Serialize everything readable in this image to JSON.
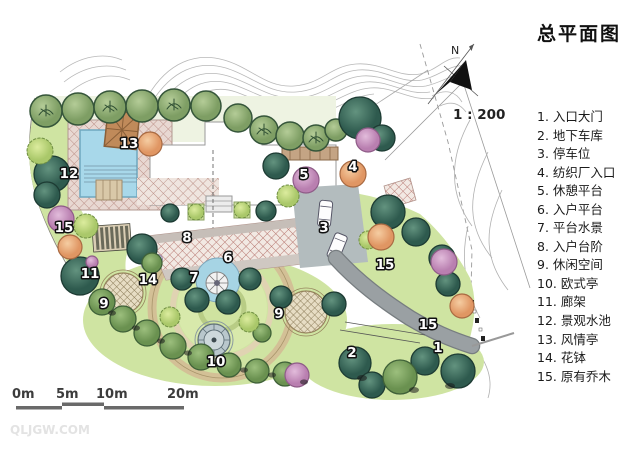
{
  "title": "总平面图",
  "north": {
    "label": "N",
    "scale_text": "1 : 200"
  },
  "legend": {
    "items": [
      "1. 入口大门",
      "2. 地下车库",
      "3. 停车位",
      "4. 纺织厂入口",
      "5. 休憩平台",
      "6. 入户平台",
      "7. 平台水景",
      "8. 入户台阶",
      "9. 休闲空间",
      "10. 欧式亭",
      "11. 廊架",
      "12. 景观水池",
      "13. 风情亭",
      "14. 花钵",
      "15. 原有乔木"
    ]
  },
  "markers": [
    {
      "num": "12"
    },
    {
      "num": "13"
    },
    {
      "num": "15"
    },
    {
      "num": "8"
    },
    {
      "num": "6"
    },
    {
      "num": "7"
    },
    {
      "num": "14"
    },
    {
      "num": "11"
    },
    {
      "num": "9"
    },
    {
      "num": "10"
    },
    {
      "num": "9"
    },
    {
      "num": "5"
    },
    {
      "num": "4"
    },
    {
      "num": "3"
    },
    {
      "num": "15"
    },
    {
      "num": "15"
    },
    {
      "num": "1"
    },
    {
      "num": "2"
    }
  ],
  "scalebar": {
    "labels": [
      "0m",
      "5m",
      "10m",
      "20m"
    ]
  },
  "watermark": "QLJGW.COM",
  "colors": {
    "pool_blue": "#a8d8ea",
    "lawn_green": "#cfe4a2",
    "ring_tan": "#d3c096",
    "road_gray": "#9aa0a3",
    "plaza_hatch": "#b5736c",
    "tree_dark_teal": "#2e5a4e",
    "tree_medium": "#6a9150",
    "tree_olive": "#7e9e64",
    "tree_pink": "#b97fb0",
    "tree_peach": "#e09663",
    "pavilion_brown": "#c08a5a"
  }
}
